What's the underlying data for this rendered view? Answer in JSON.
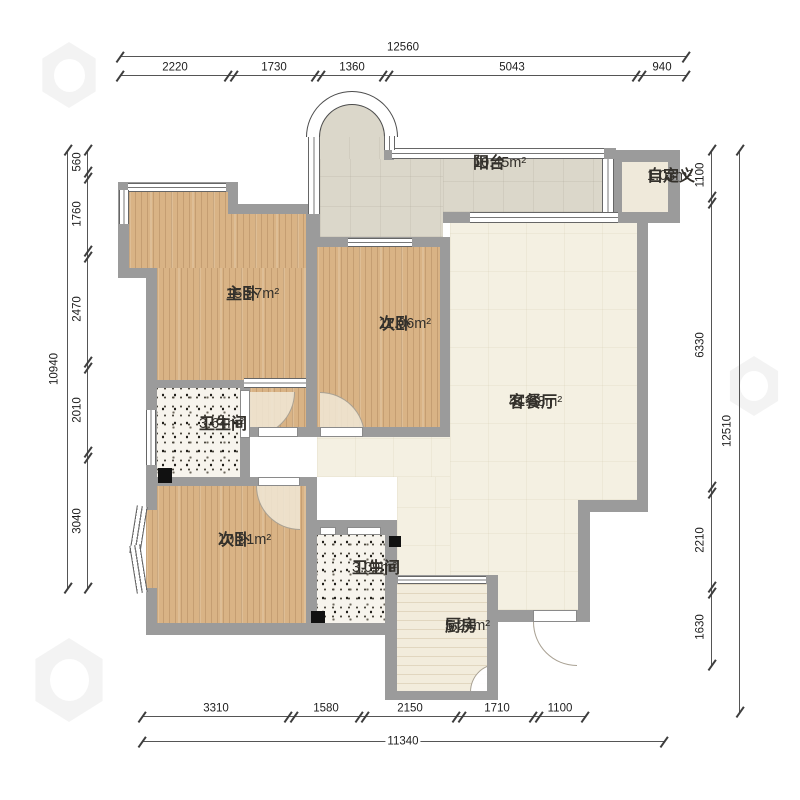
{
  "rooms": {
    "balcony": {
      "name": "阳台",
      "area": "10.45m²"
    },
    "custom_zone": {
      "name": "自定义",
      "area": "1.03m²"
    },
    "master_bedroom": {
      "name": "主卧",
      "area": "15.57m²"
    },
    "bedroom_a": {
      "name": "次卧",
      "area": "11.06m²"
    },
    "living_dining": {
      "name": "客餐厅",
      "area": "41.98m²"
    },
    "bathroom_a": {
      "name": "卫生间",
      "area": "3.64m²"
    },
    "bedroom_b": {
      "name": "次卧",
      "area": "10.91m²"
    },
    "bathroom_b": {
      "name": "卫生间",
      "area": "3.09m²"
    },
    "kitchen": {
      "name": "厨房",
      "area": "5.24m²"
    }
  },
  "dimensions": {
    "top": {
      "total": "12560",
      "segments": [
        "2220",
        "1730",
        "1360",
        "5043",
        "940"
      ]
    },
    "left": {
      "total": "10940",
      "segments": [
        "560",
        "1760",
        "2470",
        "2010",
        "3040"
      ]
    },
    "right": {
      "total": "12510",
      "segments": [
        "1100",
        "6330",
        "2210",
        "1630"
      ]
    },
    "bottom": {
      "total": "11340",
      "segments": [
        "3310",
        "1580",
        "2150",
        "1710",
        "1100"
      ]
    }
  },
  "colors": {
    "wall": "#9b9b9b",
    "wood_floor": "#d9b385",
    "tile_floor": "#f4f0e2",
    "balcony_floor": "#dbd7ca",
    "bath_floor": "#f7f4ed",
    "dimension_line": "#555555"
  }
}
